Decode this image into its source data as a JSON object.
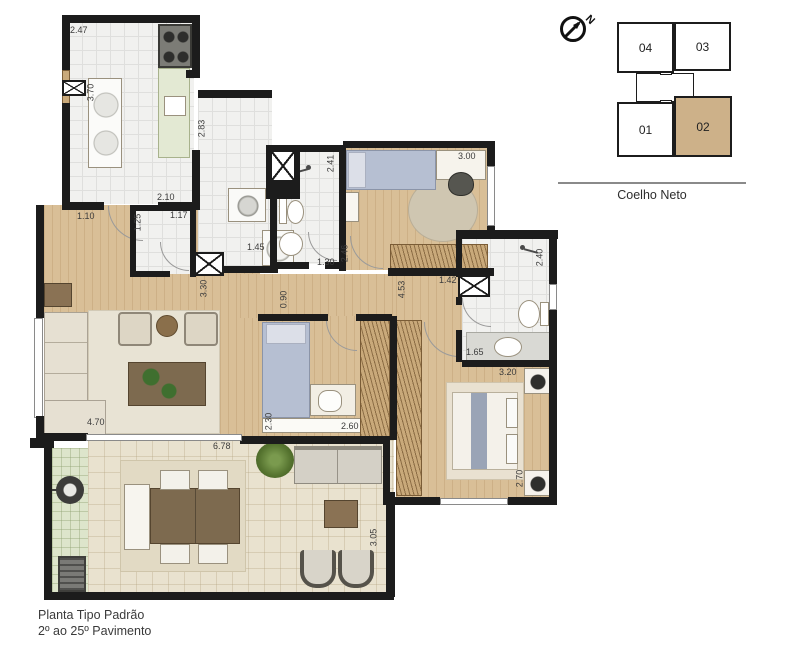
{
  "plan_title": {
    "line1": "Planta Tipo Padrão",
    "line2": "2º ao 25º Pavimento"
  },
  "key_plan": {
    "street": "Coelho Neto",
    "north_label": "N",
    "units": [
      {
        "label": "04",
        "highlighted": false
      },
      {
        "label": "03",
        "highlighted": false
      },
      {
        "label": "01",
        "highlighted": false
      },
      {
        "label": "02",
        "highlighted": true
      }
    ],
    "highlight_color": "#cdb189"
  },
  "dimensions": [
    {
      "value": "2.47",
      "x": 70,
      "y": 26,
      "v": false
    },
    {
      "value": "3.70",
      "x": 82,
      "y": 88,
      "v": true
    },
    {
      "value": "2.83",
      "x": 193,
      "y": 124,
      "v": true
    },
    {
      "value": "2.10",
      "x": 157,
      "y": 193,
      "v": false
    },
    {
      "value": "1.10",
      "x": 77,
      "y": 212,
      "v": false
    },
    {
      "value": "1.25",
      "x": 129,
      "y": 218,
      "v": true
    },
    {
      "value": "1.17",
      "x": 170,
      "y": 211,
      "v": false
    },
    {
      "value": "1.45",
      "x": 247,
      "y": 243,
      "v": false
    },
    {
      "value": "2.41",
      "x": 322,
      "y": 159,
      "v": true
    },
    {
      "value": "3.00",
      "x": 458,
      "y": 152,
      "v": false
    },
    {
      "value": "2.46",
      "x": 336,
      "y": 249,
      "v": true
    },
    {
      "value": "1.30",
      "x": 317,
      "y": 258,
      "v": false
    },
    {
      "value": "2.40",
      "x": 531,
      "y": 253,
      "v": true
    },
    {
      "value": "3.30",
      "x": 195,
      "y": 284,
      "v": true
    },
    {
      "value": "0.90",
      "x": 275,
      "y": 295,
      "v": true
    },
    {
      "value": "4.53",
      "x": 393,
      "y": 285,
      "v": true
    },
    {
      "value": "1.42",
      "x": 439,
      "y": 276,
      "v": false
    },
    {
      "value": "1.65",
      "x": 466,
      "y": 348,
      "v": false
    },
    {
      "value": "3.20",
      "x": 499,
      "y": 368,
      "v": false
    },
    {
      "value": "4.70",
      "x": 87,
      "y": 418,
      "v": false
    },
    {
      "value": "2.30",
      "x": 260,
      "y": 417,
      "v": true
    },
    {
      "value": "2.60",
      "x": 341,
      "y": 422,
      "v": false
    },
    {
      "value": "6.78",
      "x": 213,
      "y": 442,
      "v": false
    },
    {
      "value": "2.70",
      "x": 511,
      "y": 474,
      "v": true
    },
    {
      "value": "3.05",
      "x": 365,
      "y": 533,
      "v": true
    }
  ],
  "colors": {
    "wall": "#1c1c1c",
    "wood_floor": "#d9bf97",
    "tile_floor": "#f1f1ef",
    "balcony_floor": "#e9e2cf",
    "green_area": "#dde5cb",
    "highlight_unit": "#cdb189"
  }
}
